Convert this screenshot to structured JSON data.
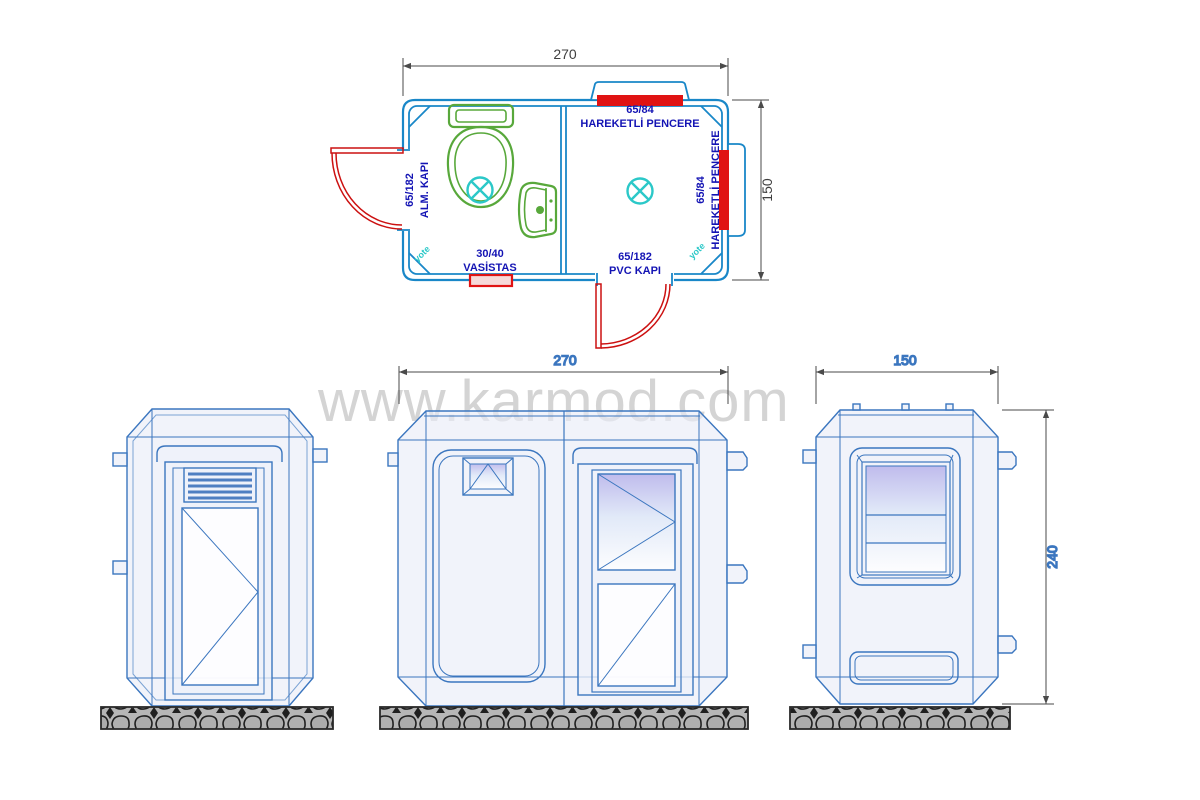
{
  "watermark": "www.karmod.com",
  "colors": {
    "plan_wall": "#1987c8",
    "label_navy": "#1414b4",
    "opening_red": "#e01313",
    "fixture_green": "#58a83b",
    "symbol_cyan": "#2bc8c8",
    "elevation_blue": "#3b76bf",
    "watermark_gray": "#d4d4d4"
  },
  "plan": {
    "width_dim": "270",
    "height_dim": "150",
    "top_window": {
      "size": "65/84",
      "name": "HAREKETLİ PENCERE"
    },
    "right_window": {
      "size": "65/84",
      "name": "HAREKETLİ PENCERE"
    },
    "left_door": {
      "size": "65/182",
      "name": "ALM. KAPI"
    },
    "bottom_door": {
      "size": "65/182",
      "name": "PVC KAPI"
    },
    "vasistas": {
      "size": "30/40",
      "name": "VASİSTAS"
    },
    "corner_note": "yote"
  },
  "front_elevation": {
    "width_dim": "270"
  },
  "right_elevation": {
    "width_dim": "150",
    "height_dim": "240"
  }
}
